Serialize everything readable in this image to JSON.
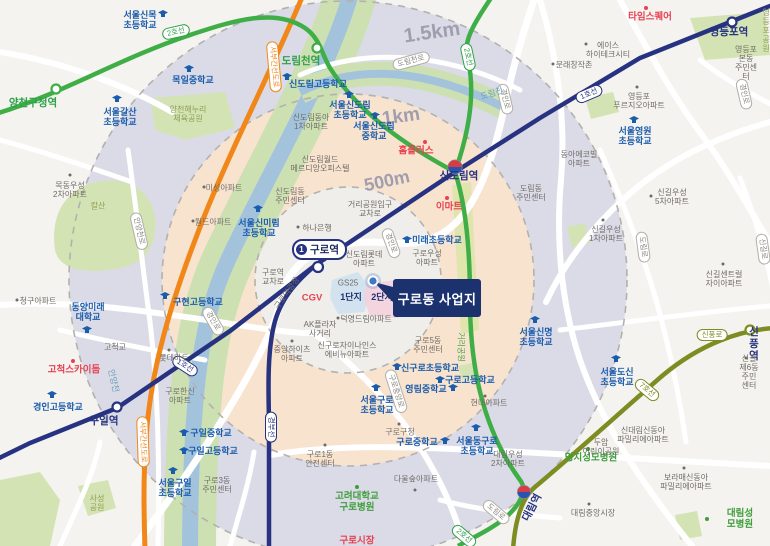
{
  "map": {
    "project_site": {
      "label": "구로동 사업지"
    },
    "guro_station_badge": {
      "line": "1",
      "name": "구로역"
    },
    "colors": {
      "line1": "#273380",
      "line2": "#3fae47",
      "line7": "#7e8d22",
      "expressway": "#f08718",
      "ring_1500m": "#dbdbe7",
      "ring_1km": "#f8e3cf",
      "ring_500m": "#efeeea",
      "school_blue": "#1b5cab",
      "landmark_red": "#e84152",
      "hospital_green": "#3f9e3c",
      "project_navy": "#1b326f",
      "river_water": "#a3c3dd",
      "river_bank": "#cde0b2"
    },
    "labels": [
      {
        "t": "1.5km",
        "x": 432,
        "y": 33,
        "c": "dist",
        "r": -8,
        "fs": 20,
        "n": "radius-label-1500m"
      },
      {
        "t": "1km",
        "x": 401,
        "y": 117,
        "c": "dist",
        "r": -8,
        "fs": 19,
        "n": "radius-label-1km"
      },
      {
        "t": "500m",
        "x": 387,
        "y": 181,
        "c": "dist",
        "r": -12,
        "fs": 18,
        "n": "radius-label-500m"
      },
      {
        "t": "양천구청역",
        "x": 33,
        "y": 104,
        "c": "st2",
        "n": "station-label-yangcheongucheong"
      },
      {
        "t": "도림천역",
        "x": 301,
        "y": 62,
        "c": "st2",
        "n": "station-label-dorimcheon"
      },
      {
        "t": "신도림역",
        "x": 459,
        "y": 177,
        "c": "st1",
        "n": "station-label-sindorim"
      },
      {
        "t": "영등포역",
        "x": 729,
        "y": 33,
        "c": "st1",
        "n": "station-label-yeongdeungpo"
      },
      {
        "t": "구일역",
        "x": 104,
        "y": 422,
        "c": "st1",
        "n": "station-label-guil"
      },
      {
        "t": "대림역",
        "x": 533,
        "y": 508,
        "c": "st1",
        "r": -62,
        "n": "station-label-daerim"
      },
      {
        "t": "신풍역",
        "x": 754,
        "y": 345,
        "c": "st1",
        "n": "station-label-sinpung"
      },
      {
        "t": "2호선",
        "x": 176,
        "y": 32,
        "c": "bdg b2",
        "r": -13,
        "n": "line2-badge"
      },
      {
        "t": "2호선",
        "x": 468,
        "y": 57,
        "c": "bdg b2",
        "r": 78,
        "n": "line2-badge"
      },
      {
        "t": "2호선",
        "x": 464,
        "y": 536,
        "c": "bdg b2",
        "r": 40,
        "n": "line2-badge"
      },
      {
        "t": "1호선",
        "x": 589,
        "y": 94,
        "c": "bdg b1",
        "r": -23,
        "n": "line1-badge"
      },
      {
        "t": "1호선",
        "x": 185,
        "y": 366,
        "c": "bdg b1",
        "r": 33,
        "n": "line1-badge"
      },
      {
        "t": "경부선",
        "x": 271,
        "y": 427,
        "c": "bdg b1",
        "r": 90,
        "n": "gyeongbu-line-badge"
      },
      {
        "t": "7호선",
        "x": 647,
        "y": 390,
        "c": "bdg b7",
        "r": 40,
        "n": "line7-badge"
      },
      {
        "t": "서부간선도로",
        "x": 274,
        "y": 67,
        "c": "bdg bo",
        "r": 85,
        "n": "expressway-badge"
      },
      {
        "t": "서부간선도로",
        "x": 143,
        "y": 442,
        "c": "bdg bo",
        "r": 88,
        "n": "expressway-badge"
      },
      {
        "t": "안양천로",
        "x": 139,
        "y": 231,
        "c": "bdg br",
        "r": 77,
        "n": "road-badge"
      },
      {
        "t": "도림천로",
        "x": 411,
        "y": 61,
        "c": "bdg br",
        "r": -15,
        "n": "road-badge"
      },
      {
        "t": "경인로",
        "x": 391,
        "y": 243,
        "c": "bdg br",
        "r": 70,
        "n": "road-badge"
      },
      {
        "t": "경인로",
        "x": 505,
        "y": 99,
        "c": "bdg br",
        "r": 77,
        "n": "road-badge"
      },
      {
        "t": "경인로",
        "x": 744,
        "y": 94,
        "c": "bdg br",
        "r": 77,
        "n": "road-badge"
      },
      {
        "t": "경인로",
        "x": 213,
        "y": 321,
        "c": "bdg br",
        "r": 60,
        "n": "road-badge"
      },
      {
        "t": "도림로",
        "x": 643,
        "y": 247,
        "c": "bdg br",
        "r": 82,
        "n": "road-badge"
      },
      {
        "t": "도림로",
        "x": 496,
        "y": 512,
        "c": "bdg br",
        "r": 40,
        "n": "road-badge"
      },
      {
        "t": "신길로",
        "x": 763,
        "y": 249,
        "c": "bdg br",
        "r": 82,
        "n": "road-badge"
      },
      {
        "t": "신풍로",
        "x": 712,
        "y": 335,
        "c": "bdg br7 b7",
        "n": "road-badge"
      },
      {
        "t": "구로중앙로",
        "x": 396,
        "y": 391,
        "c": "bdg br",
        "r": 72,
        "n": "road-badge"
      },
      {
        "t": "서울신목\n초등학교",
        "x": 140,
        "y": 20,
        "c": "sch",
        "icon": "cap",
        "ix": 163,
        "iy": 14
      },
      {
        "t": "목일중학교",
        "x": 193,
        "y": 80,
        "c": "sch",
        "icon": "cap",
        "ix": 189,
        "iy": 69
      },
      {
        "t": "서울갈산\n초등학교",
        "x": 120,
        "y": 117,
        "c": "sch",
        "icon": "cap",
        "ix": 117,
        "iy": 99
      },
      {
        "t": "신도림고등학교",
        "x": 318,
        "y": 84,
        "c": "sch",
        "icon": "cap",
        "ix": 287,
        "iy": 77
      },
      {
        "t": "서울신도림\n초등학교",
        "x": 350,
        "y": 110,
        "c": "sch",
        "icon": "cap",
        "ix": 349,
        "iy": 95
      },
      {
        "t": "서울신도림\n중학교",
        "x": 374,
        "y": 131,
        "c": "sch",
        "icon": "cap",
        "ix": 375,
        "iy": 116
      },
      {
        "t": "서울신미림\n초등학교",
        "x": 259,
        "y": 228,
        "c": "sch",
        "icon": "cap",
        "ix": 258,
        "iy": 209
      },
      {
        "t": "미래초등학교",
        "x": 437,
        "y": 240,
        "c": "sch",
        "icon": "cap",
        "ix": 407,
        "iy": 240
      },
      {
        "t": "구현고등학교",
        "x": 198,
        "y": 302,
        "c": "sch",
        "icon": "cap",
        "ix": 165,
        "iy": 296
      },
      {
        "t": "동양미래\n대학교",
        "x": 88,
        "y": 312,
        "c": "sch",
        "icon": "cap",
        "ix": 87,
        "iy": 330
      },
      {
        "t": "경인고등학교",
        "x": 58,
        "y": 407,
        "c": "sch",
        "icon": "cap",
        "ix": 52,
        "iy": 395
      },
      {
        "t": "구일중학교",
        "x": 211,
        "y": 433,
        "c": "sch",
        "icon": "cap",
        "ix": 184,
        "iy": 433
      },
      {
        "t": "구일고등학교",
        "x": 213,
        "y": 451,
        "c": "sch",
        "icon": "cap",
        "ix": 184,
        "iy": 451
      },
      {
        "t": "서울구일\n초등학교",
        "x": 175,
        "y": 488,
        "c": "sch",
        "icon": "cap",
        "ix": 173,
        "iy": 471
      },
      {
        "t": "신구로초등학교",
        "x": 430,
        "y": 368,
        "c": "sch",
        "icon": "cap",
        "ix": 397,
        "iy": 367
      },
      {
        "t": "구로고등학교",
        "x": 470,
        "y": 380,
        "c": "sch",
        "icon": "cap",
        "ix": 440,
        "iy": 380
      },
      {
        "t": "영림중학교",
        "x": 426,
        "y": 389,
        "c": "sch",
        "icon": "cap",
        "ix": 453,
        "iy": 388
      },
      {
        "t": "서울구로\n초등학교",
        "x": 377,
        "y": 405,
        "c": "sch",
        "icon": "cap",
        "ix": 376,
        "iy": 388
      },
      {
        "t": "구로중학교",
        "x": 417,
        "y": 442,
        "c": "sch",
        "icon": "cap",
        "ix": 445,
        "iy": 441
      },
      {
        "t": "서울동구로\n초등학교",
        "x": 477,
        "y": 446,
        "c": "sch",
        "icon": "cap",
        "ix": 476,
        "iy": 428
      },
      {
        "t": "서울신명\n초등학교",
        "x": 536,
        "y": 337,
        "c": "sch",
        "icon": "cap",
        "ix": 535,
        "iy": 320
      },
      {
        "t": "서울도신\n초등학교",
        "x": 617,
        "y": 377,
        "c": "sch",
        "icon": "cap",
        "ix": 616,
        "iy": 359
      },
      {
        "t": "서울영원\n초등학교",
        "x": 635,
        "y": 136,
        "c": "sch",
        "icon": "cap",
        "ix": 634,
        "iy": 120
      },
      {
        "t": "타임스퀘어",
        "x": 650,
        "y": 18,
        "c": "red",
        "icon": "rdot",
        "ix": 646,
        "iy": 8
      },
      {
        "t": "홈플러스",
        "x": 416,
        "y": 152,
        "c": "red",
        "icon": "rdot",
        "ix": 425,
        "iy": 142
      },
      {
        "t": "이마트",
        "x": 449,
        "y": 208,
        "c": "red",
        "icon": "rdot",
        "ix": 447,
        "iy": 198
      },
      {
        "t": "CGV",
        "x": 312,
        "y": 299,
        "c": "red"
      },
      {
        "t": "고척스카이돔",
        "x": 74,
        "y": 371,
        "c": "red",
        "icon": "rdot",
        "ix": 73,
        "iy": 361
      },
      {
        "t": "구로시장",
        "x": 357,
        "y": 542,
        "c": "red"
      },
      {
        "t": "고려대학교\n구로병원",
        "x": 357,
        "y": 503,
        "c": "grn",
        "icon": "gdot",
        "ix": 357,
        "iy": 487
      },
      {
        "t": "명지성모병원",
        "x": 591,
        "y": 459,
        "c": "grn",
        "icon": "gdot",
        "ix": 588,
        "iy": 449
      },
      {
        "t": "대림성모병원",
        "x": 740,
        "y": 520,
        "c": "grn",
        "icon": "gdot",
        "ix": 707,
        "iy": 519
      },
      {
        "t": "양천해누리\n체육공원",
        "x": 188,
        "y": 114,
        "c": "prk"
      },
      {
        "t": "칼산",
        "x": 98,
        "y": 206,
        "c": "prk"
      },
      {
        "t": "사성\n공원",
        "x": 97,
        "y": 503,
        "c": "prk"
      },
      {
        "t": "영등포공원",
        "x": 766,
        "y": 31,
        "c": "prk"
      },
      {
        "t": "거리공원",
        "x": 461,
        "y": 347,
        "c": "prk g",
        "r": 90
      },
      {
        "t": "도림천",
        "x": 492,
        "y": 94,
        "c": "wtr",
        "r": -18
      },
      {
        "t": "안양천",
        "x": 113,
        "y": 381,
        "c": "wtr",
        "r": 77
      },
      {
        "t": "목동우성\n2차아파트",
        "x": 70,
        "y": 190,
        "c": "pl",
        "icon": "dot",
        "ix": 70,
        "iy": 175
      },
      {
        "t": "미성아파트",
        "x": 224,
        "y": 188,
        "c": "pl",
        "icon": "dot",
        "ix": 204,
        "iy": 187
      },
      {
        "t": "월드아파트",
        "x": 213,
        "y": 222,
        "c": "pl",
        "icon": "dot",
        "ix": 193,
        "iy": 221
      },
      {
        "t": "청구아파트",
        "x": 38,
        "y": 301,
        "c": "pl",
        "icon": "dot",
        "ix": 17,
        "iy": 300
      },
      {
        "t": "신도림동아\n1차아파트",
        "x": 311,
        "y": 122,
        "c": "pl"
      },
      {
        "t": "신도림월드\n메르디앙오피스텔",
        "x": 320,
        "y": 164,
        "c": "pl"
      },
      {
        "t": "신도림동\n주민센터",
        "x": 290,
        "y": 196,
        "c": "pl"
      },
      {
        "t": "하나은행",
        "x": 317,
        "y": 228,
        "c": "pl",
        "icon": "dot",
        "ix": 298,
        "iy": 227
      },
      {
        "t": "거리공원입구\n교차로",
        "x": 370,
        "y": 209,
        "c": "pl"
      },
      {
        "t": "신도림롯데\n아파트",
        "x": 364,
        "y": 259,
        "c": "pl"
      },
      {
        "t": "구로우성\n아파트",
        "x": 427,
        "y": 258,
        "c": "pl"
      },
      {
        "t": "구로역\n교차로",
        "x": 273,
        "y": 277,
        "c": "pl"
      },
      {
        "t": "구로역광장",
        "x": 287,
        "y": 293,
        "c": "pl",
        "r": -55
      },
      {
        "t": "GS25",
        "x": 348,
        "y": 283,
        "c": "pl"
      },
      {
        "t": "덕영드림아파트",
        "x": 366,
        "y": 319,
        "c": "pl",
        "icon": "dot",
        "ix": 338,
        "iy": 318
      },
      {
        "t": "AK플라자\n사거리",
        "x": 320,
        "y": 329,
        "c": "pl"
      },
      {
        "t": "신구로자이나인스\n에비뉴아파트",
        "x": 347,
        "y": 350,
        "c": "pl"
      },
      {
        "t": "중앙하이츠\n아파트",
        "x": 292,
        "y": 354,
        "c": "pl",
        "icon": "dot",
        "ix": 292,
        "iy": 341
      },
      {
        "t": "구로5동\n주민센터",
        "x": 428,
        "y": 345,
        "c": "pl"
      },
      {
        "t": "현대아파트",
        "x": 489,
        "y": 403,
        "c": "pl",
        "icon": "dot",
        "ix": 485,
        "iy": 396
      },
      {
        "t": "구로한신\n아파트",
        "x": 180,
        "y": 396,
        "c": "pl"
      },
      {
        "t": "롯데마트",
        "x": 174,
        "y": 358,
        "c": "pl",
        "icon": "dot",
        "ix": 169,
        "iy": 350
      },
      {
        "t": "고척교",
        "x": 115,
        "y": 347,
        "c": "pl"
      },
      {
        "t": "구로3동\n주민센터",
        "x": 217,
        "y": 485,
        "c": "pl"
      },
      {
        "t": "다울숲아파트",
        "x": 416,
        "y": 479,
        "c": "pl",
        "icon": "dot",
        "ix": 415,
        "iy": 490
      },
      {
        "t": "구로1동\n안전센터",
        "x": 320,
        "y": 459,
        "c": "pl",
        "icon": "dot",
        "ix": 325,
        "iy": 445
      },
      {
        "t": "구로구청",
        "x": 400,
        "y": 432,
        "c": "pl",
        "icon": "dot",
        "ix": 399,
        "iy": 424
      },
      {
        "t": "대림우성\n2차아파트",
        "x": 508,
        "y": 459,
        "c": "pl"
      },
      {
        "t": "두암\n어린이공원",
        "x": 601,
        "y": 447,
        "c": "pl"
      },
      {
        "t": "신대림신동아\n파밀리에아파트",
        "x": 643,
        "y": 435,
        "c": "pl"
      },
      {
        "t": "보라매신동아\n파밀리에아파트",
        "x": 686,
        "y": 482,
        "c": "pl",
        "icon": "dot",
        "ix": 684,
        "iy": 468
      },
      {
        "t": "대림중앙시장",
        "x": 593,
        "y": 513,
        "c": "pl",
        "icon": "dot",
        "ix": 589,
        "iy": 504
      },
      {
        "t": "동아에코빌\n아파트",
        "x": 579,
        "y": 159,
        "c": "pl"
      },
      {
        "t": "도림동\n주민센터",
        "x": 531,
        "y": 193,
        "c": "pl"
      },
      {
        "t": "신길우성\n5차아파트",
        "x": 672,
        "y": 197,
        "c": "pl",
        "icon": "dot",
        "ix": 651,
        "iy": 196
      },
      {
        "t": "신길우성\n1차아파트",
        "x": 606,
        "y": 234,
        "c": "pl",
        "icon": "dot",
        "ix": 603,
        "iy": 220
      },
      {
        "t": "신길센트럴\n자이아파트",
        "x": 724,
        "y": 279,
        "c": "pl",
        "icon": "dot",
        "ix": 723,
        "iy": 264
      },
      {
        "t": "신길제6동\n주민센터",
        "x": 749,
        "y": 372,
        "c": "pl",
        "icon": "dot",
        "ix": 746,
        "iy": 358
      },
      {
        "t": "에이스\n하이테크시티",
        "x": 608,
        "y": 50,
        "c": "pl",
        "icon": "dot",
        "ix": 586,
        "iy": 44
      },
      {
        "t": "문래창작촌",
        "x": 574,
        "y": 65,
        "c": "pl",
        "icon": "dot",
        "ix": 553,
        "iy": 64
      },
      {
        "t": "영등포본동\n주민센터",
        "x": 746,
        "y": 63,
        "c": "pl"
      },
      {
        "t": "영등포\n푸르지오아파트",
        "x": 639,
        "y": 101,
        "c": "pl",
        "icon": "dot",
        "ix": 637,
        "iy": 87
      },
      {
        "t": "1단지",
        "x": 351,
        "y": 297,
        "c": "unit",
        "n": "complex-1-label"
      },
      {
        "t": "2단지",
        "x": 382,
        "y": 297,
        "c": "unit",
        "n": "complex-2-label"
      }
    ]
  }
}
